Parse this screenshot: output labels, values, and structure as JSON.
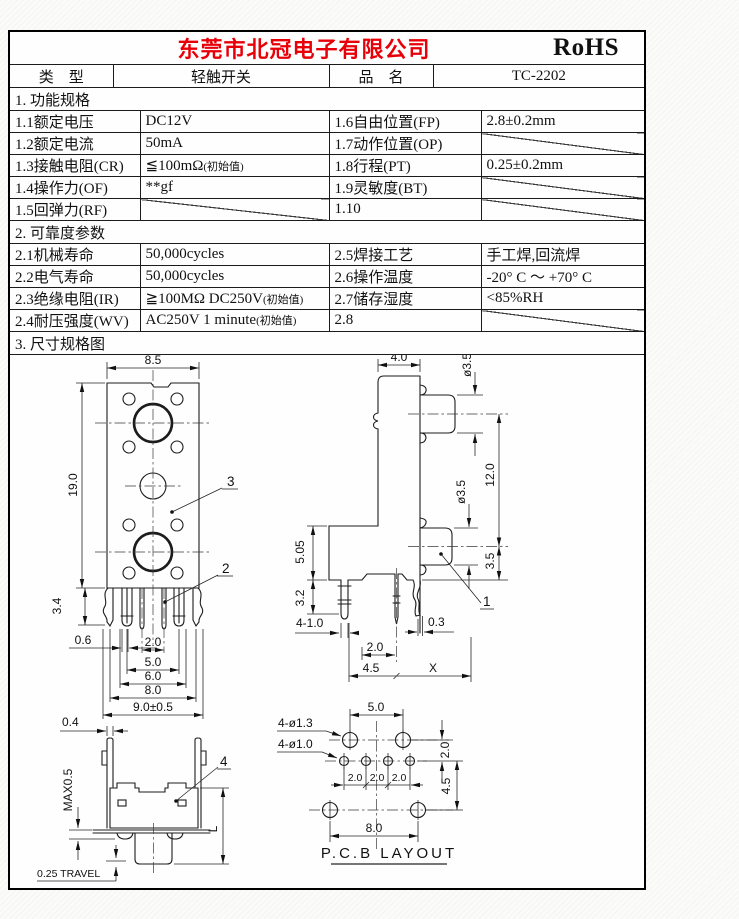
{
  "header": {
    "company": "东莞市北冠电子有限公司",
    "cert": "RoHS"
  },
  "meta": {
    "type_label": "类　型",
    "type_value": "轻触开关",
    "name_label": "品　名",
    "name_value": "TC-2202"
  },
  "sections": {
    "s1": "1.  功能规格",
    "s2": "2.  可靠度参数",
    "s3": "3.  尺寸规格图"
  },
  "spec_rows": [
    {
      "c1": "1.1额定电压",
      "c2": "DC12V",
      "c2_note": "",
      "c3": "1.6自由位置(FP)",
      "c4": "2.8±0.2mm"
    },
    {
      "c1": "1.2额定电流",
      "c2": "50mA",
      "c2_note": "",
      "c3": "1.7动作位置(OP)",
      "c4": ""
    },
    {
      "c1": "1.3接触电阻(CR)",
      "c2": "≦100mΩ",
      "c2_note": "(初始值)",
      "c3": "1.8行程(PT)",
      "c4": "0.25±0.2mm"
    },
    {
      "c1": "1.4操作力(OF)",
      "c2": "**gf",
      "c2_note": "",
      "c3": "1.9灵敏度(BT)",
      "c4": ""
    },
    {
      "c1": "1.5回弹力(RF)",
      "c2": "",
      "c2_note": "",
      "c3": "1.10",
      "c4": ""
    }
  ],
  "rel_rows": [
    {
      "c1": "2.1机械寿命",
      "c2": "50,000cycles",
      "c2_note": "",
      "c3": "2.5焊接工艺",
      "c4": "手工焊,回流焊"
    },
    {
      "c1": "2.2电气寿命",
      "c2": "50,000cycles",
      "c2_note": "",
      "c3": "2.6操作温度",
      "c4": "-20° C ～ +70° C"
    },
    {
      "c1": "2.3绝缘电阻(IR)",
      "c2": "≧100MΩ DC250V",
      "c2_note": "(初始值)",
      "c3": "2.7储存湿度",
      "c4": "<85%RH"
    },
    {
      "c1": "2.4耐压强度(WV)",
      "c2": "AC250V 1 minute",
      "c2_note": "(初始值)",
      "c3": "2.8",
      "c4": ""
    }
  ],
  "front": {
    "w": "8.5",
    "h": "19.0",
    "pin_h": "3.4",
    "pin_w": "0.6",
    "d1": "2.0",
    "d2": "5.0",
    "d3": "6.0",
    "d4": "8.0",
    "d5": "9.0±0.5",
    "b2": "2",
    "b3": "3"
  },
  "side": {
    "w": "4.0",
    "dia_top": "ø3.5",
    "span": "12.0",
    "dia_mid": "ø3.5",
    "bot": "3.5",
    "l1": "5.05",
    "l2": "3.2",
    "legs": "4-1.0",
    "g1": "0.3",
    "g2": "2.0",
    "g3": "4.5",
    "gx": "X",
    "b1": "1"
  },
  "bracket": {
    "w": "0.4",
    "max": "MAX0.5",
    "travel": "0.25 TRAVEL",
    "len": "L",
    "b4": "4"
  },
  "pcb": {
    "holes_big": "4-ø1.3",
    "holes_small": "4-ø1.0",
    "top": "5.0",
    "r1": "2.0",
    "r2": "4.5",
    "p1": "2.0",
    "p2": "2.0",
    "p3": "2.0",
    "bottom": "8.0",
    "title": "P.C.B LAYOUT"
  }
}
